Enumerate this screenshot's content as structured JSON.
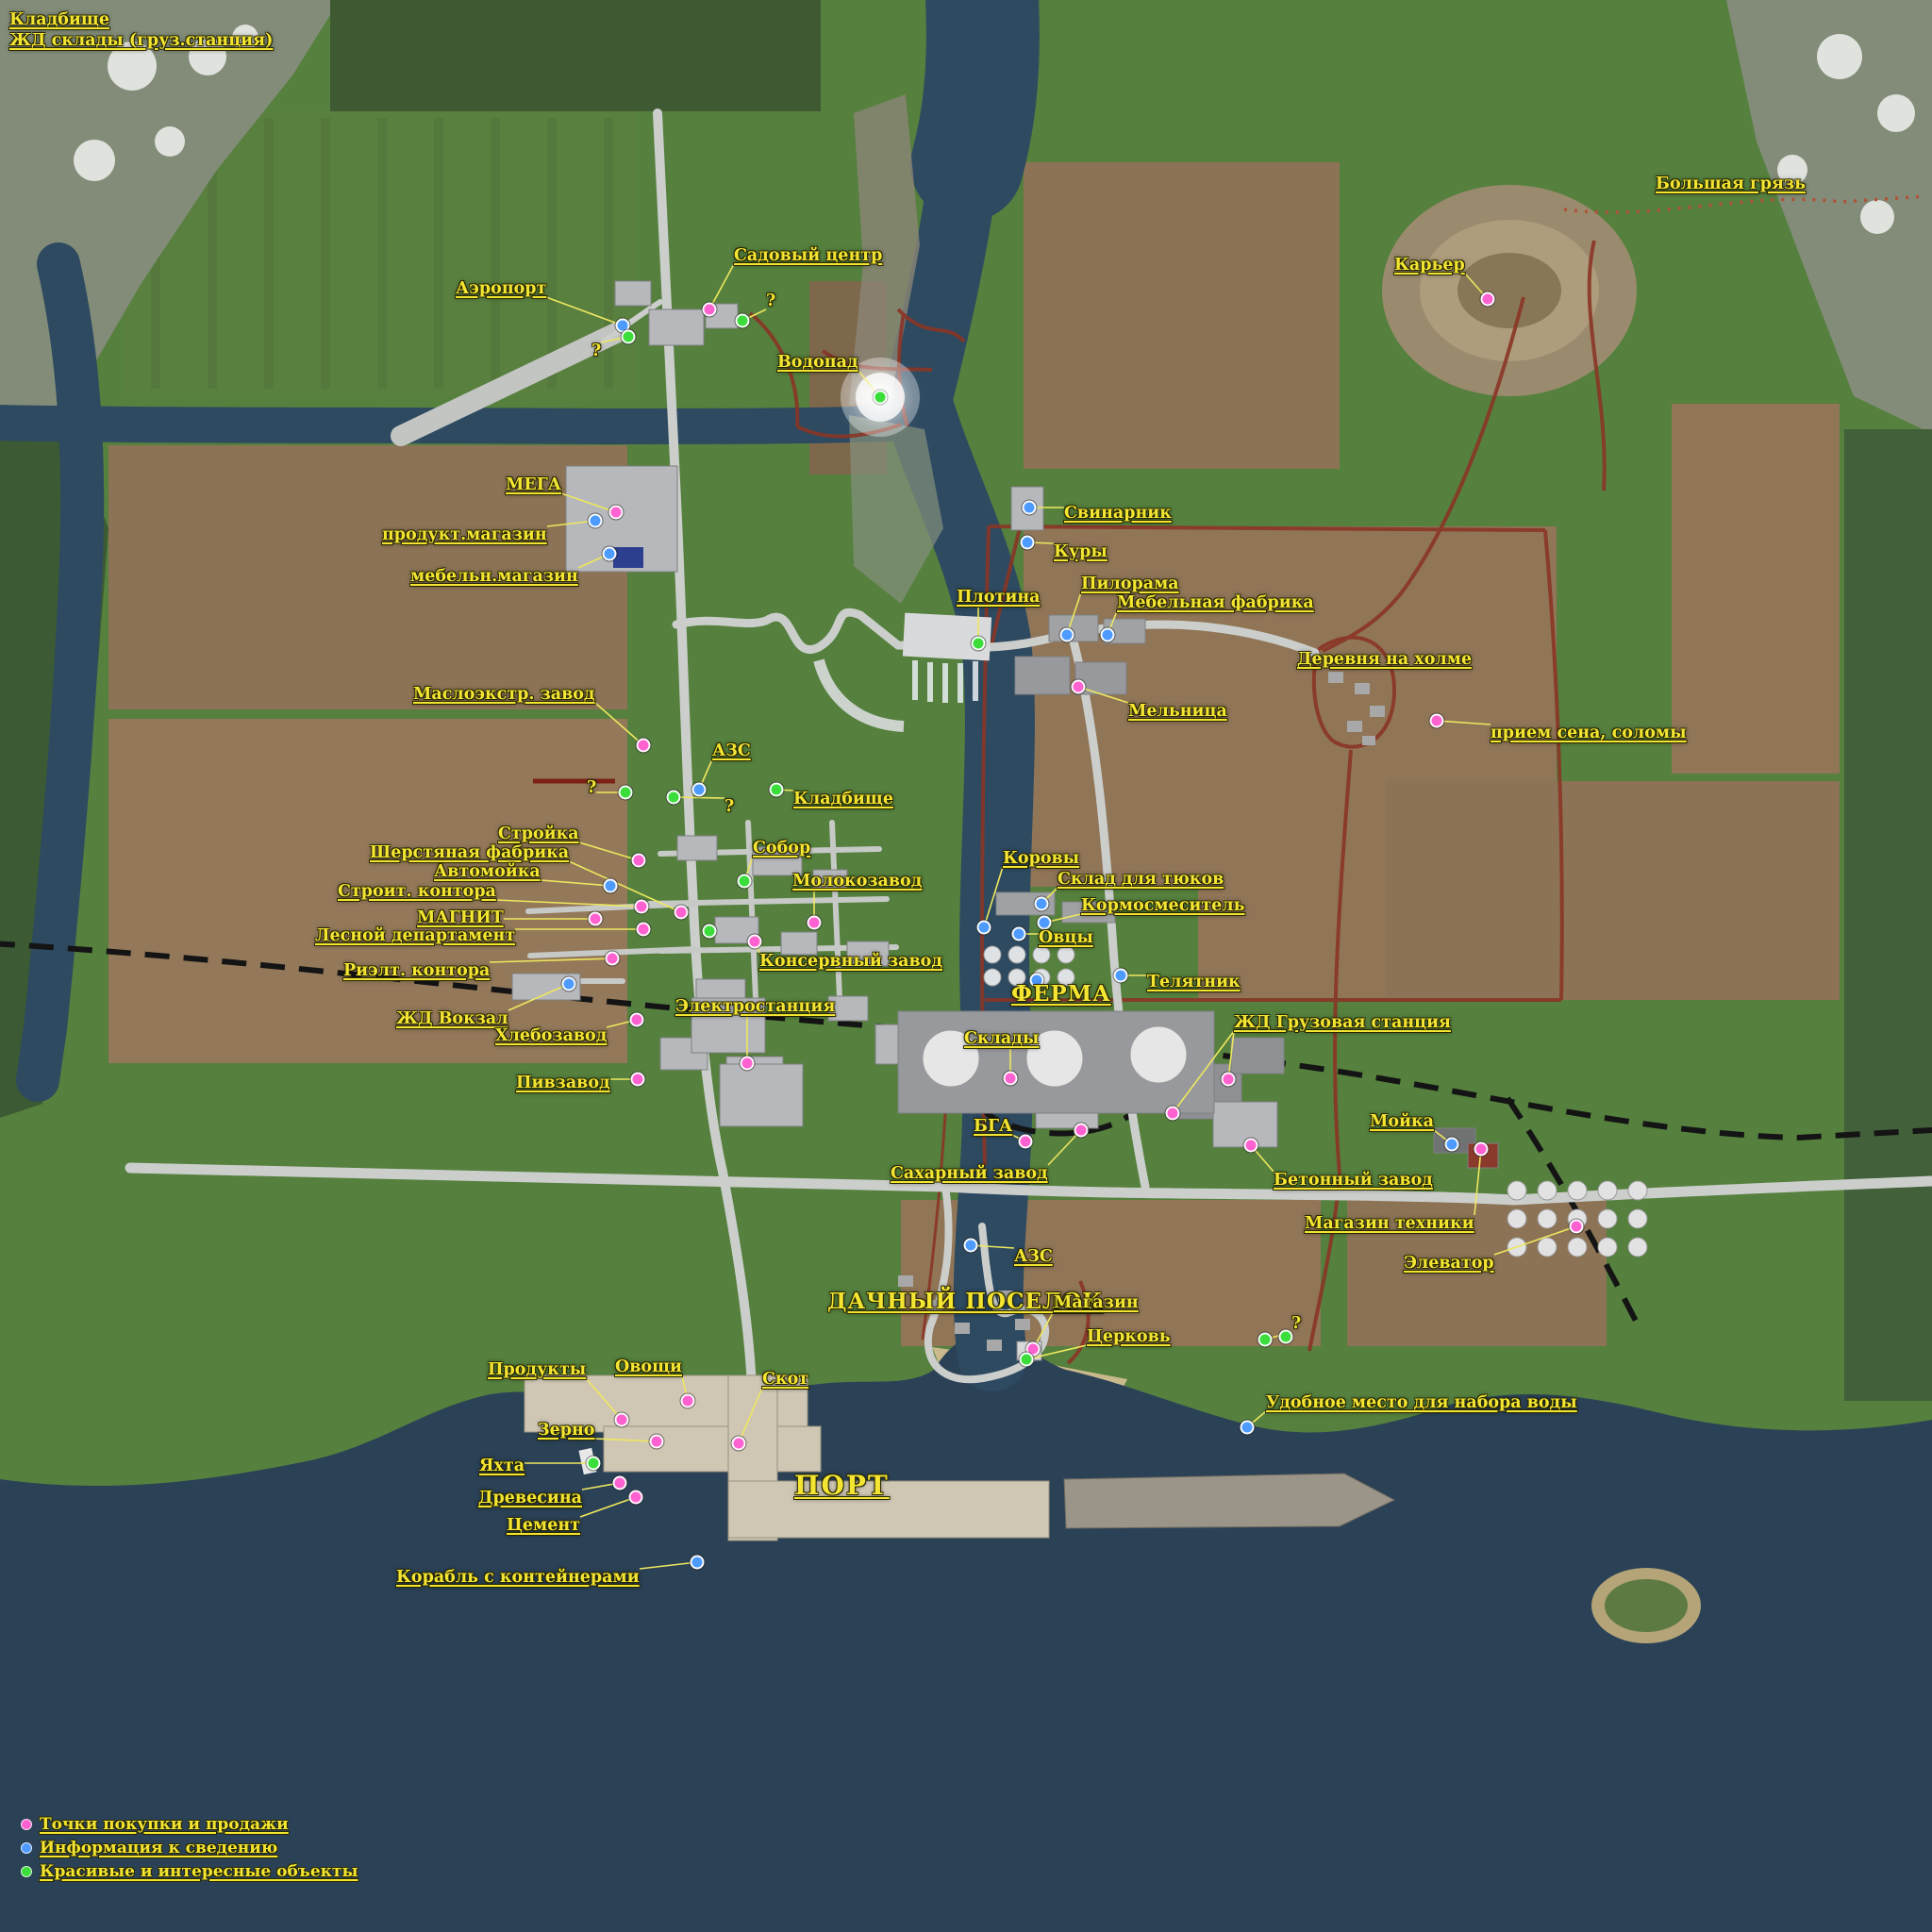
{
  "map_title": "Карта",
  "marker_colors": {
    "pink": "#ff62d0",
    "blue": "#4e9bff",
    "green": "#3bdd3b"
  },
  "label_color": "#f4e533",
  "line_color": "#eee75e",
  "legend": {
    "items": [
      {
        "color": "pink",
        "label": "Точки покупки и продажи"
      },
      {
        "color": "blue",
        "label": "Информация к сведению"
      },
      {
        "color": "green",
        "label": "Красивые и интересные объекты"
      }
    ]
  },
  "markers": [
    {
      "id": "corner-cemetery",
      "label": "Кладбище",
      "color": null,
      "dots": [],
      "label_pos": [
        10,
        12
      ],
      "size": "md"
    },
    {
      "id": "corner-rail-depot",
      "label": "ЖД склады (груз.станция)",
      "color": null,
      "dots": [],
      "label_pos": [
        10,
        34
      ],
      "size": "md"
    },
    {
      "id": "airport",
      "label": "Аэропорт",
      "color": "blue",
      "dots": [
        [
          660,
          345
        ]
      ],
      "label_pos": [
        483,
        297
      ],
      "size": "md"
    },
    {
      "id": "airport-question",
      "label": "?",
      "color": "green",
      "dots": [
        [
          666,
          357
        ]
      ],
      "label_pos": [
        627,
        363
      ],
      "size": "md",
      "underline": false
    },
    {
      "id": "garden-center",
      "label": "Садовый центр",
      "color": "pink",
      "dots": [
        [
          752,
          328
        ]
      ],
      "label_pos": [
        778,
        262
      ],
      "size": "md"
    },
    {
      "id": "garden-question",
      "label": "?",
      "color": "green",
      "dots": [
        [
          787,
          340
        ]
      ],
      "label_pos": [
        812,
        310
      ],
      "size": "md",
      "underline": false
    },
    {
      "id": "waterfall",
      "label": "Водопад",
      "color": "green",
      "dots": [
        [
          933,
          421
        ]
      ],
      "label_pos": [
        824,
        375
      ],
      "size": "md",
      "halo": true
    },
    {
      "id": "mega",
      "label": "МЕГА",
      "color": "pink",
      "dots": [
        [
          653,
          543
        ]
      ],
      "label_pos": [
        536,
        505
      ],
      "size": "md"
    },
    {
      "id": "mega-grocery",
      "label": "продукт.магазин",
      "color": "blue",
      "dots": [
        [
          631,
          552
        ]
      ],
      "label_pos": [
        405,
        558
      ],
      "size": "md"
    },
    {
      "id": "mega-furniture",
      "label": "мебельн.магазин",
      "color": "blue",
      "dots": [
        [
          646,
          587
        ]
      ],
      "label_pos": [
        435,
        602
      ],
      "size": "md"
    },
    {
      "id": "quarry",
      "label": "Карьер",
      "color": "pink",
      "dots": [
        [
          1577,
          317
        ]
      ],
      "label_pos": [
        1478,
        272
      ],
      "size": "md"
    },
    {
      "id": "big-mud",
      "label": "Большая грязь",
      "color": null,
      "dots": [],
      "label_pos": [
        1755,
        186
      ],
      "size": "md"
    },
    {
      "id": "pigsty",
      "label": "Свинарник",
      "color": "blue",
      "dots": [
        [
          1091,
          538
        ]
      ],
      "label_pos": [
        1128,
        535
      ],
      "size": "md"
    },
    {
      "id": "chickens",
      "label": "Куры",
      "color": "blue",
      "dots": [
        [
          1089,
          575
        ]
      ],
      "label_pos": [
        1117,
        576
      ],
      "size": "md"
    },
    {
      "id": "sawmill",
      "label": "Пилорама",
      "color": "blue",
      "dots": [
        [
          1131,
          673
        ]
      ],
      "label_pos": [
        1146,
        610
      ],
      "size": "md"
    },
    {
      "id": "furniture-factory",
      "label": "Мебельная фабрика",
      "color": "blue",
      "dots": [
        [
          1174,
          673
        ]
      ],
      "label_pos": [
        1184,
        630
      ],
      "size": "md"
    },
    {
      "id": "dam",
      "label": "Плотина",
      "color": "green",
      "dots": [
        [
          1037,
          682
        ]
      ],
      "label_pos": [
        1014,
        624
      ],
      "size": "md"
    },
    {
      "id": "mill",
      "label": "Мельница",
      "color": "pink",
      "dots": [
        [
          1143,
          728
        ]
      ],
      "label_pos": [
        1196,
        745
      ],
      "size": "md"
    },
    {
      "id": "hill-village",
      "label": "Деревня на холме",
      "color": null,
      "dots": [],
      "label_pos": [
        1375,
        690
      ],
      "size": "md"
    },
    {
      "id": "hay-straw",
      "label": "прием сена, соломы",
      "color": "pink",
      "dots": [
        [
          1523,
          764
        ]
      ],
      "label_pos": [
        1580,
        768
      ],
      "size": "md"
    },
    {
      "id": "oil-plant",
      "label": "Маслоэкстр. завод",
      "color": "pink",
      "dots": [
        [
          682,
          790
        ]
      ],
      "label_pos": [
        438,
        727
      ],
      "size": "md"
    },
    {
      "id": "gas-station-1",
      "label": "АЗС",
      "color": "blue",
      "dots": [
        [
          741,
          837
        ]
      ],
      "label_pos": [
        755,
        787
      ],
      "size": "md"
    },
    {
      "id": "question-1",
      "label": "?",
      "color": "green",
      "dots": [
        [
          663,
          840
        ]
      ],
      "label_pos": [
        622,
        826
      ],
      "size": "md",
      "underline": false
    },
    {
      "id": "question-2",
      "label": "?",
      "color": "green",
      "dots": [
        [
          714,
          845
        ]
      ],
      "label_pos": [
        768,
        846
      ],
      "size": "md",
      "underline": false
    },
    {
      "id": "cemetery-city",
      "label": "Кладбище",
      "color": "green",
      "dots": [
        [
          823,
          837
        ]
      ],
      "label_pos": [
        841,
        838
      ],
      "size": "md"
    },
    {
      "id": "construction",
      "label": "Стройка",
      "color": "pink",
      "dots": [
        [
          677,
          912
        ]
      ],
      "label_pos": [
        528,
        875
      ],
      "size": "md"
    },
    {
      "id": "wool-factory",
      "label": "Шерстяная фабрика",
      "color": "pink",
      "dots": [
        [
          722,
          967
        ]
      ],
      "label_pos": [
        392,
        895
      ],
      "size": "md"
    },
    {
      "id": "carwash",
      "label": "Автомойка",
      "color": "blue",
      "dots": [
        [
          647,
          939
        ]
      ],
      "label_pos": [
        460,
        915
      ],
      "size": "md"
    },
    {
      "id": "builders-office",
      "label": "Строит. контора",
      "color": "pink",
      "dots": [
        [
          680,
          961
        ]
      ],
      "label_pos": [
        358,
        936
      ],
      "size": "md"
    },
    {
      "id": "magnit",
      "label": "МАГНИТ",
      "color": "pink",
      "dots": [
        [
          631,
          974
        ]
      ],
      "label_pos": [
        442,
        964
      ],
      "size": "md"
    },
    {
      "id": "forestry-dept",
      "label": "Лесной департамент",
      "color": "pink",
      "dots": [
        [
          682,
          985
        ]
      ],
      "label_pos": [
        334,
        983
      ],
      "size": "md"
    },
    {
      "id": "cathedral",
      "label": "Собор",
      "color": "green",
      "dots": [
        [
          789,
          934
        ]
      ],
      "label_pos": [
        798,
        890
      ],
      "size": "md"
    },
    {
      "id": "dairy-plant",
      "label": "Молокозавод",
      "color": "pink",
      "dots": [
        [
          863,
          978
        ]
      ],
      "label_pos": [
        840,
        925
      ],
      "size": "md"
    },
    {
      "id": "green-unlabeled",
      "label": "",
      "color": "green",
      "dots": [
        [
          752,
          987
        ]
      ],
      "label_pos": null
    },
    {
      "id": "realtor-office",
      "label": "Риэлт. контора",
      "color": "pink",
      "dots": [
        [
          649,
          1016
        ]
      ],
      "label_pos": [
        364,
        1020
      ],
      "size": "md"
    },
    {
      "id": "rail-station",
      "label": "ЖД Вокзал",
      "color": "blue",
      "dots": [
        [
          603,
          1043
        ]
      ],
      "label_pos": [
        420,
        1071
      ],
      "size": "md"
    },
    {
      "id": "bread-factory",
      "label": "Хлебозавод",
      "color": "pink",
      "dots": [
        [
          675,
          1081
        ]
      ],
      "label_pos": [
        525,
        1089
      ],
      "size": "md"
    },
    {
      "id": "power-plant",
      "label": "Электростанция",
      "color": "pink",
      "dots": [
        [
          792,
          1127
        ]
      ],
      "label_pos": [
        716,
        1058
      ],
      "size": "md"
    },
    {
      "id": "brewery",
      "label": "Пивзавод",
      "color": "pink",
      "dots": [
        [
          676,
          1144
        ]
      ],
      "label_pos": [
        547,
        1139
      ],
      "size": "md"
    },
    {
      "id": "cannery",
      "label": "Консервный завод",
      "color": "pink",
      "dots": [
        [
          800,
          998
        ]
      ],
      "label_pos": [
        805,
        1010
      ],
      "size": "md"
    },
    {
      "id": "cows",
      "label": "Коровы",
      "color": "blue",
      "dots": [
        [
          1043,
          983
        ]
      ],
      "label_pos": [
        1063,
        901
      ],
      "size": "md"
    },
    {
      "id": "bale-storage",
      "label": "Склад для тюков",
      "color": "blue",
      "dots": [
        [
          1104,
          958
        ]
      ],
      "label_pos": [
        1121,
        923
      ],
      "size": "md"
    },
    {
      "id": "feed-mixer",
      "label": "Кормосмеситель",
      "color": "blue",
      "dots": [
        [
          1107,
          978
        ]
      ],
      "label_pos": [
        1146,
        951
      ],
      "size": "md"
    },
    {
      "id": "sheep",
      "label": "Овцы",
      "color": "blue",
      "dots": [
        [
          1080,
          990
        ]
      ],
      "label_pos": [
        1101,
        985
      ],
      "size": "md"
    },
    {
      "id": "farm-blue-dot",
      "label": "",
      "color": "blue",
      "dots": [
        [
          1099,
          1039
        ]
      ],
      "label_pos": null
    },
    {
      "id": "farm",
      "label": "ФЕРМА",
      "color": null,
      "dots": [],
      "label_pos": [
        1072,
        1042
      ],
      "size": "lg"
    },
    {
      "id": "calf-barn",
      "label": "Телятник",
      "color": "blue",
      "dots": [
        [
          1188,
          1034
        ]
      ],
      "label_pos": [
        1216,
        1032
      ],
      "size": "md"
    },
    {
      "id": "warehouses",
      "label": "Склады",
      "color": "pink",
      "dots": [
        [
          1071,
          1143
        ]
      ],
      "label_pos": [
        1022,
        1092
      ],
      "size": "md"
    },
    {
      "id": "freight-station",
      "label": "ЖД Грузовая станция",
      "color": "pink",
      "dots": [
        [
          1302,
          1144
        ],
        [
          1243,
          1180
        ]
      ],
      "label_pos": [
        1308,
        1075
      ],
      "size": "md"
    },
    {
      "id": "bga",
      "label": "БГА",
      "color": "pink",
      "dots": [
        [
          1087,
          1210
        ]
      ],
      "label_pos": [
        1032,
        1185
      ],
      "size": "md"
    },
    {
      "id": "vehicle-wash",
      "label": "Мойка",
      "color": "blue",
      "dots": [
        [
          1539,
          1213
        ]
      ],
      "label_pos": [
        1452,
        1180
      ],
      "size": "md"
    },
    {
      "id": "sugar-factory",
      "label": "Сахарный завод",
      "color": "pink",
      "dots": [
        [
          1146,
          1198
        ]
      ],
      "label_pos": [
        944,
        1235
      ],
      "size": "md"
    },
    {
      "id": "concrete-plant",
      "label": "Бетонный завод",
      "color": "pink",
      "dots": [
        [
          1326,
          1214
        ]
      ],
      "label_pos": [
        1350,
        1242
      ],
      "size": "md"
    },
    {
      "id": "equipment-shop",
      "label": "Магазин техники",
      "color": "pink",
      "dots": [
        [
          1570,
          1218
        ]
      ],
      "label_pos": [
        1383,
        1288
      ],
      "size": "md"
    },
    {
      "id": "elevator",
      "label": "Элеватор",
      "color": "pink",
      "dots": [
        [
          1671,
          1300
        ]
      ],
      "label_pos": [
        1488,
        1330
      ],
      "size": "md"
    },
    {
      "id": "gas-station-2",
      "label": "АЗС",
      "color": "blue",
      "dots": [
        [
          1029,
          1320
        ]
      ],
      "label_pos": [
        1075,
        1323
      ],
      "size": "md"
    },
    {
      "id": "dacha-village",
      "label": "ДАЧНЫЙ ПОСЕЛОК",
      "color": null,
      "dots": [],
      "label_pos": [
        877,
        1368
      ],
      "size": "lg"
    },
    {
      "id": "shop",
      "label": "Магазин",
      "color": "pink",
      "dots": [
        [
          1095,
          1430
        ]
      ],
      "label_pos": [
        1117,
        1372
      ],
      "size": "md"
    },
    {
      "id": "church",
      "label": "Церковь",
      "color": "green",
      "dots": [
        [
          1088,
          1441
        ]
      ],
      "label_pos": [
        1152,
        1408
      ],
      "size": "md"
    },
    {
      "id": "question-3",
      "label": "?",
      "color": "green",
      "dots": [
        [
          1341,
          1420
        ],
        [
          1363,
          1417
        ]
      ],
      "label_pos": [
        1369,
        1394
      ],
      "size": "md",
      "underline": false
    },
    {
      "id": "water-fill-spot",
      "label": "Удобное место для набора воды",
      "color": "blue",
      "dots": [
        [
          1322,
          1513
        ]
      ],
      "label_pos": [
        1342,
        1478
      ],
      "size": "md"
    },
    {
      "id": "food-sale",
      "label": "Продукты",
      "color": "pink",
      "dots": [
        [
          659,
          1505
        ]
      ],
      "label_pos": [
        517,
        1443
      ],
      "size": "md"
    },
    {
      "id": "vegetables",
      "label": "Овощи",
      "color": "pink",
      "dots": [
        [
          729,
          1485
        ]
      ],
      "label_pos": [
        652,
        1440
      ],
      "size": "md"
    },
    {
      "id": "livestock",
      "label": "Скот",
      "color": "pink",
      "dots": [
        [
          783,
          1530
        ]
      ],
      "label_pos": [
        808,
        1453
      ],
      "size": "md"
    },
    {
      "id": "grain",
      "label": "Зерно",
      "color": "pink",
      "dots": [
        [
          696,
          1528
        ]
      ],
      "label_pos": [
        570,
        1507
      ],
      "size": "md"
    },
    {
      "id": "yacht",
      "label": "Яхта",
      "color": "green",
      "dots": [
        [
          629,
          1551
        ]
      ],
      "label_pos": [
        508,
        1545
      ],
      "size": "md"
    },
    {
      "id": "wood-sale",
      "label": "Древесина",
      "color": "pink",
      "dots": [
        [
          657,
          1572
        ]
      ],
      "label_pos": [
        507,
        1579
      ],
      "size": "md"
    },
    {
      "id": "cement",
      "label": "Цемент",
      "color": "pink",
      "dots": [
        [
          674,
          1587
        ]
      ],
      "label_pos": [
        537,
        1608
      ],
      "size": "md"
    },
    {
      "id": "port",
      "label": "ПОРТ",
      "color": null,
      "dots": [],
      "label_pos": [
        842,
        1560
      ],
      "size": "xl"
    },
    {
      "id": "container-ship",
      "label": "Корабль с контейнерами",
      "color": "blue",
      "dots": [
        [
          739,
          1656
        ]
      ],
      "label_pos": [
        420,
        1663
      ],
      "size": "md"
    }
  ]
}
